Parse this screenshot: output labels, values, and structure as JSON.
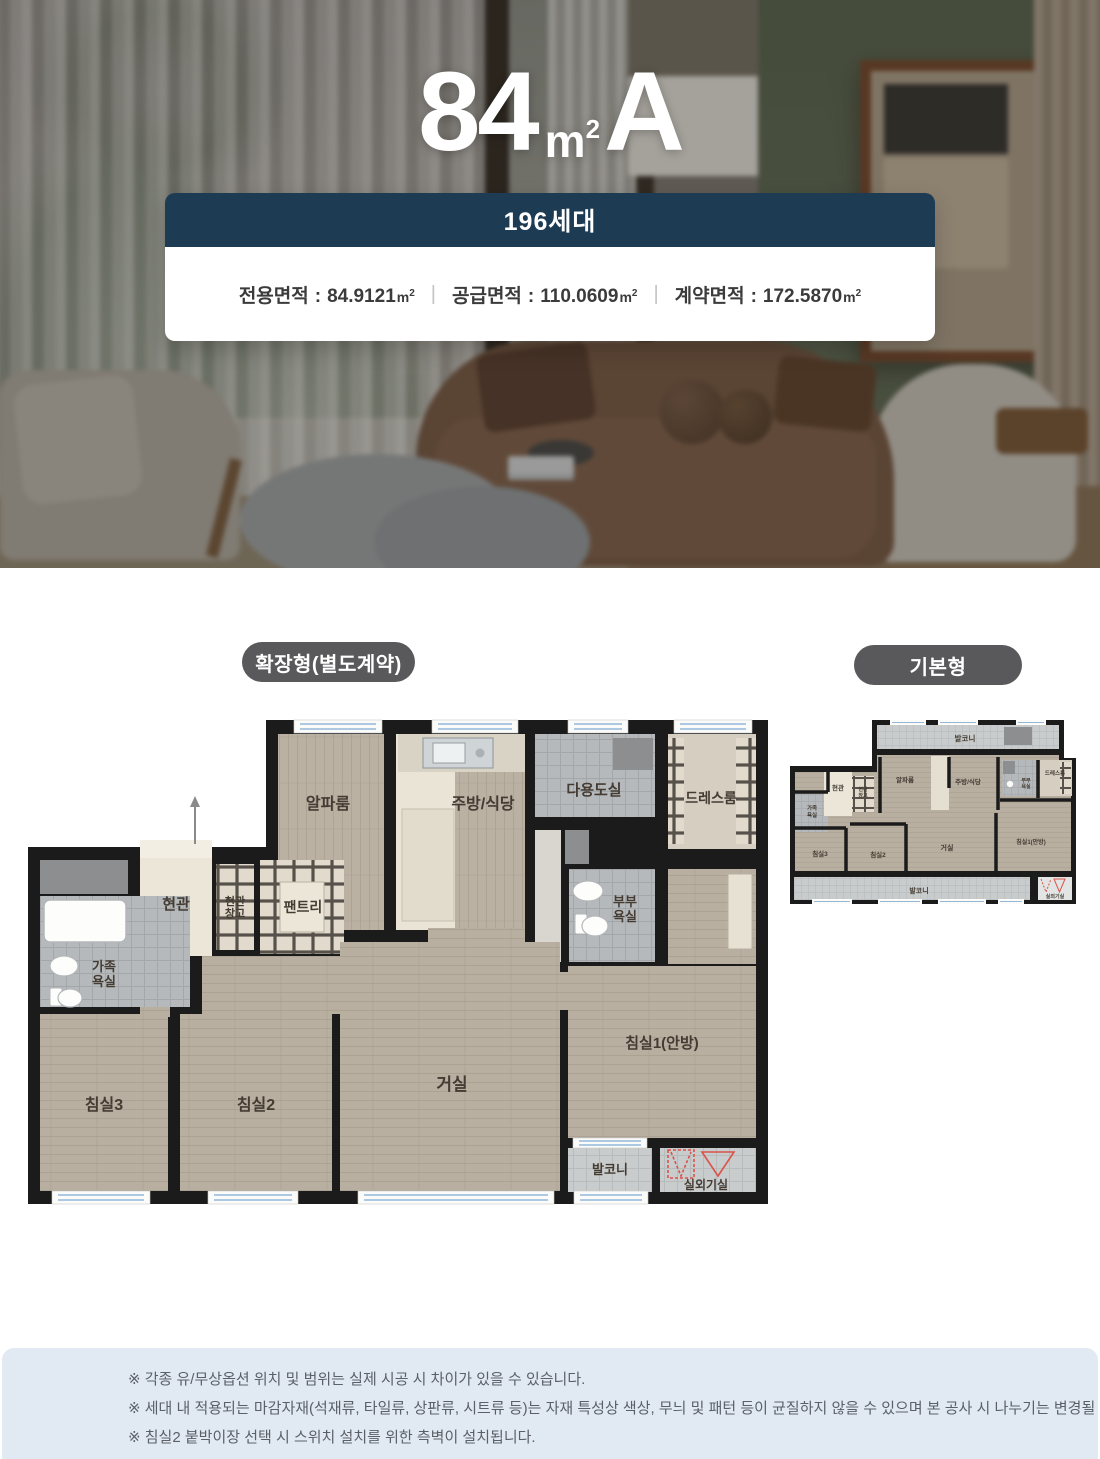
{
  "hero": {
    "title": {
      "number": "84",
      "unit_base": "m",
      "unit_sup": "2",
      "letter": "A"
    },
    "card": {
      "households": "196세대",
      "colon": ":",
      "divider": "|",
      "areas": [
        {
          "label": "전용면적",
          "value": "84.9121",
          "unit_base": "m",
          "unit_sup": "2"
        },
        {
          "label": "공급면적",
          "value": "110.0609",
          "unit_base": "m",
          "unit_sup": "2"
        },
        {
          "label": "계약면적",
          "value": "172.5870",
          "unit_base": "m",
          "unit_sup": "2"
        }
      ]
    }
  },
  "plans": {
    "extended": {
      "badge": "확장형(별도계약)",
      "labels": {
        "alpha": "알파룸",
        "kitchen": "주방/식당",
        "utility": "다용도실",
        "dress": "드레스룸",
        "entry": "현관",
        "entry_storage_l1": "현관",
        "entry_storage_l2": "창고",
        "pantry": "팬트리",
        "master_bath_l1": "부부",
        "master_bath_l2": "욕실",
        "family_bath_l1": "가족",
        "family_bath_l2": "욕실",
        "bedroom3": "침실3",
        "bedroom2": "침실2",
        "living": "거실",
        "bedroom1": "침실1(안방)",
        "balcony": "발코니",
        "outdoor_unit": "실외기실"
      }
    },
    "basic": {
      "badge": "기본형",
      "labels": {
        "balcony_top": "발코니",
        "alpha": "알파룸",
        "kitchen": "주방/식당",
        "dress": "드레스룸",
        "entry": "현관",
        "entry_storage_l1": "현관",
        "entry_storage_l2": "창고",
        "master_bath_l1": "부부",
        "master_bath_l2": "욕실",
        "family_bath_l1": "가족",
        "family_bath_l2": "욕실",
        "bedroom3": "침실3",
        "bedroom2": "침실2",
        "living": "거실",
        "bedroom1": "침실1(안방)",
        "balcony_bottom": "발코니",
        "outdoor_unit": "실외기실"
      }
    }
  },
  "notes": {
    "items": [
      "※ 각종 유/무상옵션 위치 및 범위는 실제 시공 시 차이가 있을 수 있습니다.",
      "※ 세대 내 적용되는 마감자재(석재류, 타일류, 상판류, 시트류 등)는 자재 특성상 색상, 무늬 및 패턴 등이 균질하지 않을 수 있으며 본 공사 시 나누기는 변경될 수 있습니다.",
      "※ 침실2 붙박이장 선택 시 스위치 설치를 위한 측벽이 설치됩니다."
    ]
  },
  "colors": {
    "navy_header": "#1e3b54",
    "badge_gray": "#59595b",
    "notes_bg": "#e1eaf2",
    "wall_black": "#1b1b1b",
    "wood_floor": "#b8afa1",
    "tile_gray": "#b6b9bb",
    "outdoor_unit_red": "#d9534a",
    "window_blue": "#93b8da"
  }
}
